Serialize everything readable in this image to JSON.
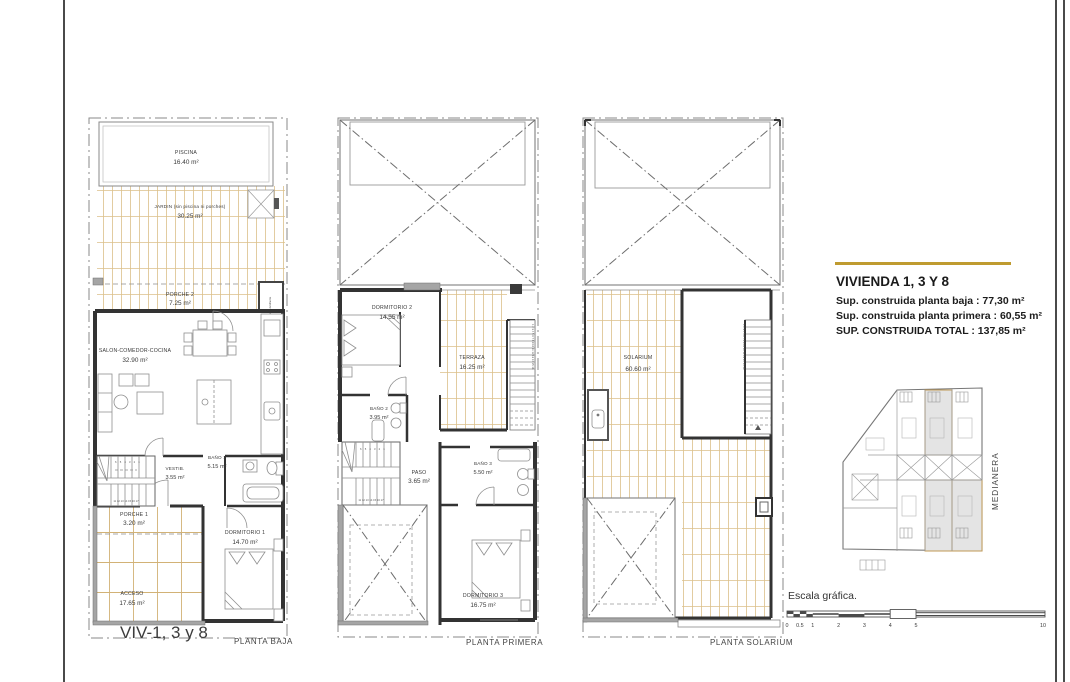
{
  "info_panel": {
    "title": "VIVIENDA 1, 3 Y 8",
    "sup_baja": "Sup. construida planta baja : 77,30 m²",
    "sup_primera": "Sup. construida planta primera : 60,55 m²",
    "sup_total": "SUP. CONSTRUIDA TOTAL : 137,85 m²",
    "accent_color": "#bf9b30"
  },
  "captions": {
    "viv": "VIV-1, 3 y 8",
    "baja": "PLANTA BAJA",
    "primera": "PLANTA PRIMERA",
    "solarium": "PLANTA SOLARIUM"
  },
  "planta_baja": {
    "piscina_name": "PISCINA",
    "piscina_area": "16.40 m²",
    "jardin_name": "JARDIN (sin piscina ni porches)",
    "jardin_area": "30.25 m²",
    "porche2_name": "PORCHE 2",
    "porche2_area": "7.25 m²",
    "armario_label": "Armario Jardinería",
    "salon_name": "SALON-COMEDOR-COCINA",
    "salon_area": "32.90 m²",
    "bano1_name": "BAÑO 1",
    "bano1_area": "5.15 m²",
    "vestib_name": "VESTIB.",
    "vestib_area": "3.55 m²",
    "porche1_name": "PORCHE 1",
    "porche1_area": "3.20 m²",
    "dorm1_name": "DORMITORIO 1",
    "dorm1_area": "14.70 m²",
    "acceso_name": "ACCESO",
    "acceso_area": "17.65 m²",
    "stairs_top": "6 5 4 3 2 1",
    "stairs_bottom": "11 12 13 14 15 16 17"
  },
  "planta_primera": {
    "dorm2_name": "DORMITORIO 2",
    "dorm2_area": "14.55 m²",
    "terraza_name": "TERRAZA",
    "terraza_area": "16.25 m²",
    "bano2_name": "BAÑO 2",
    "bano2_area": "3.95 m²",
    "paso_name": "PASO",
    "paso_area": "3.65 m²",
    "bano3_name": "BAÑO 3",
    "bano3_area": "5.50 m²",
    "dorm3_name": "DORMITORIO 3",
    "dorm3_area": "16.75 m²",
    "stairs_top": "6 5 4 3 2 1",
    "stairs_bottom": "11 12 13 14 15 16 17",
    "stairs_side": "1 2 3 4 5 6 7 8 9 10 11 12 13 14 15 16"
  },
  "planta_solarium": {
    "solarium_name": "SOLARIUM",
    "solarium_area": "60.60 m²",
    "stairs_side": "1 2 3 4 5 6 7 8 9 10 11 12 13 14 15 16"
  },
  "site_plan": {
    "medianera_label": "MEDIANERA"
  },
  "scale_bar": {
    "label": "Escala gráfica.",
    "ticks": [
      "0",
      "0.5",
      "1",
      "2",
      "3",
      "4",
      "5",
      "10"
    ]
  }
}
